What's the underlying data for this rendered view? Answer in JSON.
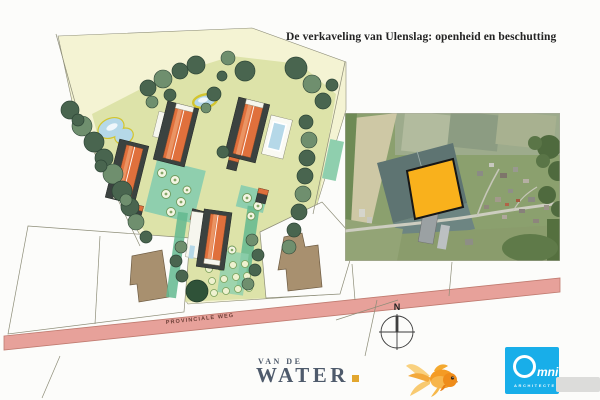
{
  "page": {
    "title": "De verkaveling van Ulenslag: openheid en beschutting"
  },
  "site_plan": {
    "road_label": "PROVINCIALE WEG"
  },
  "compass": {
    "north_label": "N"
  },
  "logos": {
    "van_de_water": {
      "top": "VAN DE",
      "bottom": "WATER"
    },
    "omni": {
      "mni": "mni",
      "subtext": "ARCHITECTEN"
    }
  },
  "icons": {
    "compass": "compass-rose-north",
    "goldfish": "goldfish-mascot",
    "omni_ring": "letter-o-ring",
    "accent_square": "orange-square-bullet"
  },
  "palette": {
    "paper": "#fcfcfa",
    "ink": "#232323",
    "plan_yellow": "#f4f3d3",
    "plan_lawn": "#dde3a9",
    "tree_dark": "#49654f",
    "tree_light": "#6f8f6e",
    "tree_stroke": "#2e4637",
    "roof_orange": "#e0703c",
    "roof_light": "#ea9464",
    "building_dark": "#3b4240",
    "building_white": "#f6f6ee",
    "courtyard_teal": "#8fcfae",
    "hedge_teal": "#63b98f",
    "pond_blue": "#b5d8e8",
    "pond_ring": "#d3c52f",
    "existing_brown": "#a8906f",
    "road_pink": "#e7a19a",
    "road_stroke": "#c07b70",
    "road_text": "#6d4038",
    "line": "#8d8d78",
    "photo_green": "#8ba06e",
    "photo_dark_field": "#5e7472",
    "photo_tan": "#cec8a5",
    "parcel_orange": "#f9b11c",
    "vdw_blue": "#4e5a6b",
    "vdw_accent": "#e2a62e",
    "omni_cyan": "#18aee9"
  }
}
